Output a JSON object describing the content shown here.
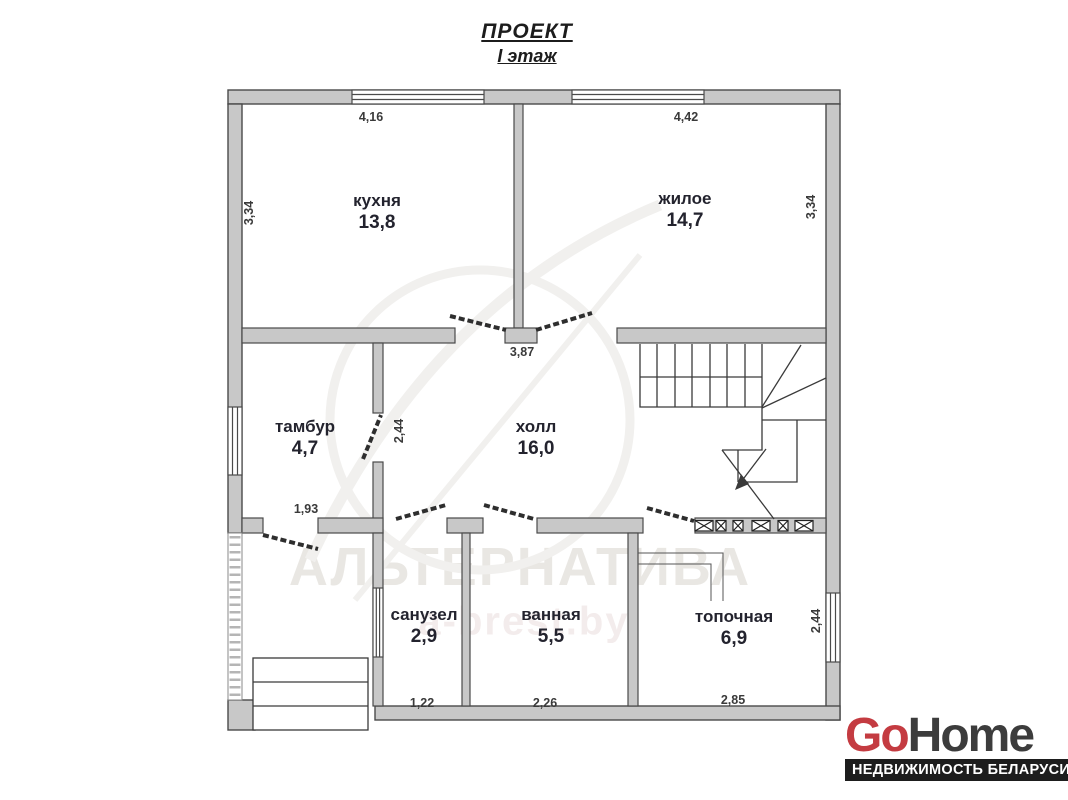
{
  "title": {
    "line1": "ПРОЕКТ",
    "line2": "I этаж"
  },
  "rooms": {
    "kitchen": {
      "name": "кухня",
      "area": "13,8"
    },
    "living": {
      "name": "жилое",
      "area": "14,7"
    },
    "vestibule": {
      "name": "тамбур",
      "area": "4,7"
    },
    "hall": {
      "name": "холл",
      "area": "16,0"
    },
    "wc": {
      "name": "санузел",
      "area": "2,9"
    },
    "bath": {
      "name": "ванная",
      "area": "5,5"
    },
    "boiler": {
      "name": "топочная",
      "area": "6,9"
    }
  },
  "dimensions": {
    "kitchen_width": "4,16",
    "living_width": "4,42",
    "kitchen_depth": "3,34",
    "living_depth": "3,34",
    "hall_width": "3,87",
    "vestibule_door_depth": "2,44",
    "vestibule_width": "1,93",
    "wc_width": "1,22",
    "bath_width": "2,26",
    "boiler_width": "2,85",
    "boiler_depth": "2,44"
  },
  "watermark": {
    "brand": "АЛЬТЕРНАТИВА",
    "site": "a-brest.by"
  },
  "logo": {
    "part1": "Go",
    "part2": "Home",
    "tagline": "НЕДВИЖИМОСТЬ БЕЛАРУСИ",
    "accent_color": "#c43b41",
    "text_color": "#3c3c3c",
    "bar_color": "#1d1d1d"
  },
  "plan": {
    "wall_color": "#c8c8c8",
    "line_color": "#4a4a4a"
  }
}
